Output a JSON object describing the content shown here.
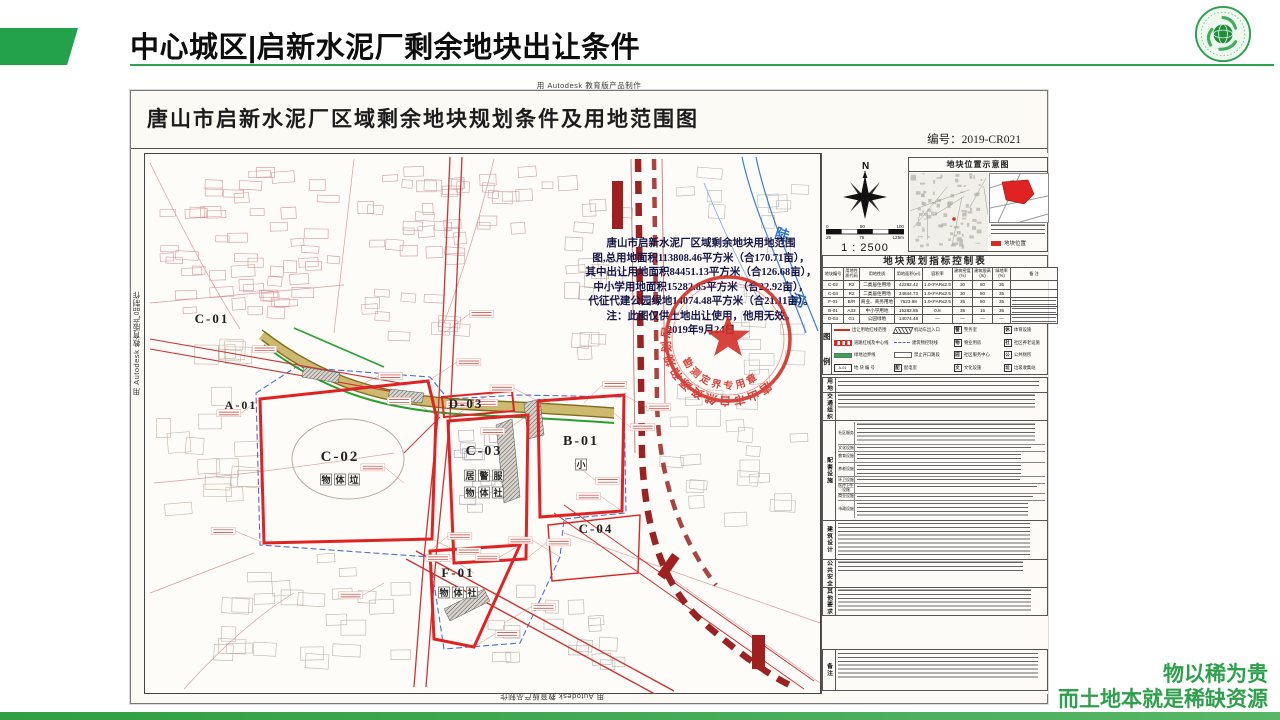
{
  "slide": {
    "title": "中心城区|启新水泥厂剩余地块出让条件",
    "slogan_line1": "物以稀为贵",
    "slogan_line2": "而土地本就是稀缺资源",
    "accent_color": "#23a24b"
  },
  "document": {
    "watermark": "用 Autodesk 教育版产品制作",
    "title": "唐山市启新水泥厂区域剩余地块规划条件及用地范围图",
    "number": "编号：2019-CR021",
    "annotation_lines": [
      "唐山市启新水泥厂区域剩余地块用地范围",
      "图,总用地面积113808.46平方米（合170.71亩），",
      "其中出让用地面积84451.13平方米（合126.68亩），",
      "中小学用地面积15282.85平方米（合22.92亩），",
      "代征代建公园绿地14074.48平方米（合21.11亩）。",
      "注：此图仅供土地出让使用，他用无效。",
      "2019年9月24日"
    ],
    "stamp": {
      "arc_top": "唐山市自然资源和规划局",
      "arc_bottom": "勘测定界专用章"
    },
    "river_label": [
      "陡",
      "河"
    ],
    "plots": [
      {
        "id": "C-01",
        "x": 68,
        "y": 170,
        "size": 13,
        "icons": []
      },
      {
        "id": "A-01",
        "x": 97,
        "y": 256,
        "size": 12,
        "icons": []
      },
      {
        "id": "C-02",
        "x": 196,
        "y": 308,
        "size": 15,
        "icons": [
          "物体垃"
        ],
        "iy": 330
      },
      {
        "id": "D-03",
        "x": 322,
        "y": 255,
        "size": 13,
        "icons": [],
        "iy": 0
      },
      {
        "id": "C-03",
        "x": 340,
        "y": 302,
        "size": 14,
        "icons": [
          "居警服",
          "物体社"
        ],
        "iy": 326
      },
      {
        "id": "B-01",
        "x": 437,
        "y": 292,
        "size": 14,
        "icons": [
          "小"
        ],
        "iy": 315
      },
      {
        "id": "C-04",
        "x": 452,
        "y": 380,
        "size": 13,
        "icons": []
      },
      {
        "id": "F-01",
        "x": 314,
        "y": 424,
        "size": 13,
        "icons": [
          "物体社"
        ],
        "iy": 443
      }
    ]
  },
  "panel": {
    "compass": {
      "north": "N",
      "ratio": "1 : 2500",
      "ticks_top": [
        "0",
        "50",
        "100"
      ],
      "ticks_bottom": [
        "25",
        "75",
        "125m"
      ]
    },
    "location": {
      "title": "地块位置示意图",
      "key_label": "地块位置",
      "key_color": "#d42b22"
    },
    "table": {
      "title": "地块规划指标控制表",
      "headers": [
        "地块编号",
        "用地性质代码",
        "用地性质",
        "用地面积(㎡)",
        "容积率",
        "建筑密度(%)",
        "建筑限高(m)",
        "绿地率(%)",
        "备 注"
      ],
      "rows": [
        [
          "C-02",
          "R2",
          "二类居住用地",
          "42282.42",
          "1.0<FAR≤2.5",
          "30",
          "80",
          "35",
          ""
        ],
        [
          "C-03",
          "R2",
          "二类居住用地",
          "34844.73",
          "1.0<FAR≤2.5",
          "30",
          "80",
          "35",
          ""
        ],
        [
          "F-01",
          "B/R",
          "商业、商务用地",
          "7523.98",
          "1.0<FAR≤2.5",
          "35",
          "80",
          "35",
          "#"
        ],
        [
          "B-01",
          "A33",
          "中小学用地",
          "15282.85",
          "0.8",
          "35",
          "15",
          "35",
          "#"
        ],
        [
          "D-03",
          "G1",
          "公园绿地",
          "14074.48",
          "—",
          "—",
          "—",
          "—",
          "#"
        ]
      ]
    },
    "legend": {
      "caption": [
        "图",
        "例"
      ],
      "items": [
        {
          "sym": "redline",
          "label": "出让用地红线范围"
        },
        {
          "sym": "hatch",
          "label": "机动车出入口"
        },
        {
          "sym": "badge",
          "badge": "警",
          "label": "警务室"
        },
        {
          "sym": "badge",
          "badge": "休",
          "label": "体育设施"
        },
        {
          "sym": "redstripe",
          "label": "道路红线及中心线"
        },
        {
          "sym": "bluedash",
          "label": "建筑物控制线"
        },
        {
          "sym": "badge",
          "badge": "物",
          "label": "物业用房"
        },
        {
          "sym": "badge",
          "badge": "社",
          "label": "社区养老设施"
        },
        {
          "sym": "greenline",
          "label": "绿地边界线"
        },
        {
          "sym": "plain",
          "label": "禁止开口路段"
        },
        {
          "sym": "badge",
          "badge": "园",
          "label": "社区服务中心"
        },
        {
          "sym": "badge",
          "badge": "公",
          "label": "公共厕所"
        },
        {
          "sym": "idbox",
          "badge": "A-01",
          "label": "地 块 编 号"
        },
        {
          "sym": "badge",
          "badge": "配",
          "label": "配电室"
        },
        {
          "sym": "badge",
          "badge": "文",
          "label": "文化设施"
        },
        {
          "sym": "badge",
          "badge": "垃",
          "label": "垃圾收集站"
        }
      ]
    },
    "notes_sections": [
      {
        "label": "用地",
        "lines": 2
      },
      {
        "label": "交通组织",
        "lines": 4
      },
      {
        "label": "配套设施",
        "subs": [
          {
            "label": "社区服务",
            "lines": 5
          },
          {
            "label": "文化设施",
            "lines": 1
          },
          {
            "label": "教育设施",
            "lines": 2
          },
          {
            "label": "养老设施",
            "lines": 3
          },
          {
            "label": "环卫设施",
            "lines": 1
          },
          {
            "label": "医疗卫生设施",
            "lines": 1
          },
          {
            "label": "商业设施",
            "lines": 1
          },
          {
            "label": "市政设施",
            "lines": 4
          }
        ]
      },
      {
        "label": "建筑设计",
        "lines": 9
      },
      {
        "label": "公共安全",
        "lines": 3
      },
      {
        "label": "其他要求",
        "lines": 6
      }
    ],
    "remark_label": "备注",
    "remark_lines": 7
  }
}
